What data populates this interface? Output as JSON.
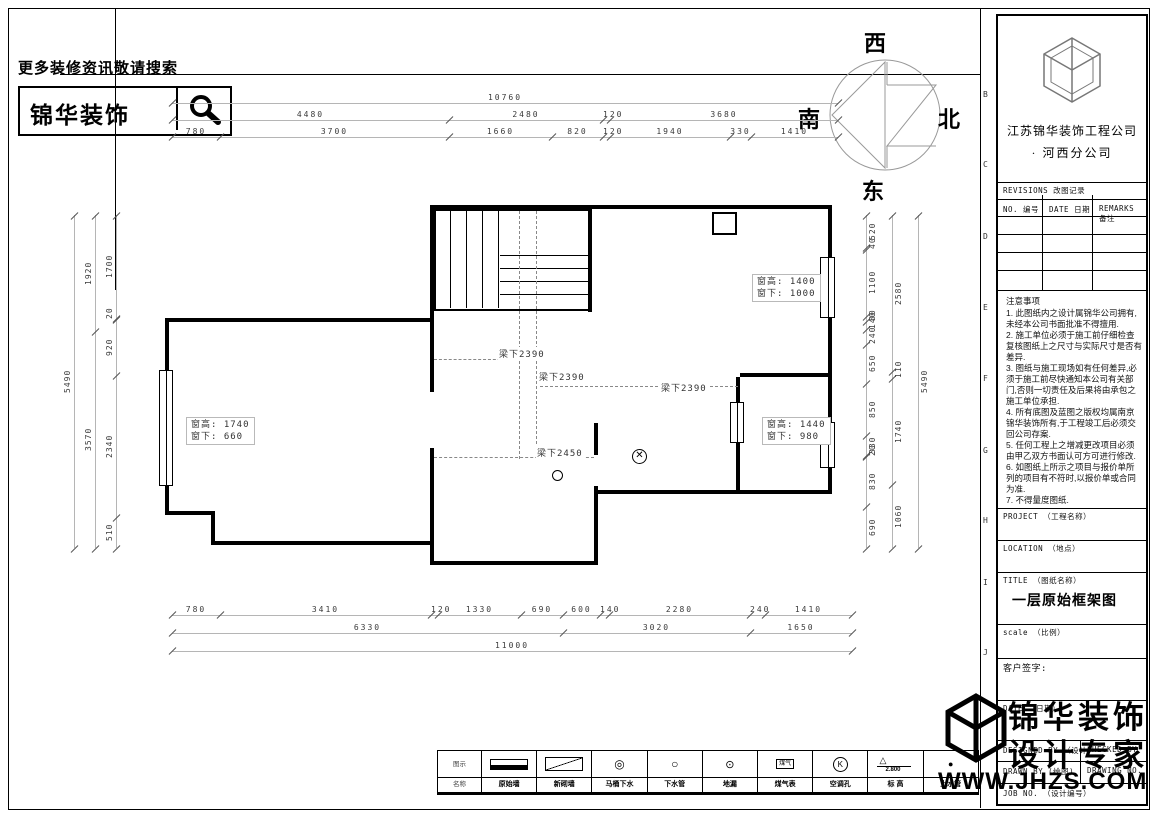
{
  "header": {
    "search_hint": "更多装修资讯敬请搜索",
    "brand": "锦华装饰",
    "search_icon": "magnifier-icon"
  },
  "compass": {
    "west": "西",
    "north": "北",
    "east": "东",
    "south": "南"
  },
  "plan": {
    "beam_labels": [
      {
        "text": "梁下2390",
        "x": 498,
        "y": 347
      },
      {
        "text": "梁下2390",
        "x": 538,
        "y": 370
      },
      {
        "text": "梁下2390",
        "x": 660,
        "y": 381
      },
      {
        "text": "梁下2450",
        "x": 536,
        "y": 446
      }
    ],
    "window_tags": [
      {
        "line1": "窗高: 1400",
        "line2": "窗下: 1000",
        "x": 752,
        "y": 274
      },
      {
        "line1": "窗高: 1740",
        "line2": "窗下: 660",
        "x": 186,
        "y": 417
      },
      {
        "line1": "窗高: 1440",
        "line2": "窗下: 980",
        "x": 762,
        "y": 417
      }
    ]
  },
  "dim_chains": [
    {
      "id": "top-total",
      "orient": "h",
      "x": 172,
      "y": 90,
      "len": 666,
      "side": "T",
      "values": [
        10760
      ]
    },
    {
      "id": "top-mid",
      "orient": "h",
      "x": 172,
      "y": 107,
      "len": 666,
      "side": "T",
      "values": [
        4480,
        2480,
        120,
        3680
      ]
    },
    {
      "id": "top-detail",
      "orient": "h",
      "x": 172,
      "y": 124,
      "len": 666,
      "side": "T",
      "values": [
        780,
        3700,
        1660,
        820,
        120,
        1940,
        330,
        1410
      ]
    },
    {
      "id": "bottom-detail",
      "orient": "h",
      "x": 172,
      "y": 602,
      "len": 680,
      "side": "T",
      "values": [
        780,
        3410,
        120,
        1330,
        690,
        600,
        140,
        2280,
        240,
        1410
      ]
    },
    {
      "id": "bottom-mid",
      "orient": "h",
      "x": 172,
      "y": 620,
      "len": 680,
      "side": "T",
      "values": [
        6330,
        3020,
        1650
      ]
    },
    {
      "id": "bottom-total",
      "orient": "h",
      "x": 172,
      "y": 638,
      "len": 680,
      "side": "T",
      "values": [
        11000
      ]
    },
    {
      "id": "left-total",
      "orient": "v",
      "x": 62,
      "y": 215,
      "len": 333,
      "side": "L",
      "values": [
        5490
      ]
    },
    {
      "id": "left-mid",
      "orient": "v",
      "x": 83,
      "y": 215,
      "len": 333,
      "side": "L",
      "values": [
        1920,
        3570
      ]
    },
    {
      "id": "left-detail",
      "orient": "v",
      "x": 104,
      "y": 215,
      "len": 333,
      "side": "L",
      "values": [
        1700,
        20,
        920,
        2340,
        510
      ]
    },
    {
      "id": "right-detail",
      "orient": "v",
      "x": 864,
      "y": 215,
      "len": 333,
      "side": "R",
      "values": [
        520,
        40,
        1100,
        80,
        140,
        240,
        650,
        850,
        330,
        20,
        830,
        690
      ]
    },
    {
      "id": "right-mid",
      "orient": "v",
      "x": 890,
      "y": 215,
      "len": 333,
      "side": "R",
      "values": [
        2580,
        110,
        1740,
        1060
      ]
    },
    {
      "id": "right-total",
      "orient": "v",
      "x": 916,
      "y": 215,
      "len": 333,
      "side": "R",
      "values": [
        5490
      ]
    }
  ],
  "legend": {
    "header_top": "图示",
    "header_bottom": "名称",
    "items": [
      {
        "name": "原始墙",
        "symbol": "wall-orig"
      },
      {
        "name": "新砌墙",
        "symbol": "wall-new"
      },
      {
        "name": "马桶下水",
        "symbol": "drain-double"
      },
      {
        "name": "下水管",
        "symbol": "drain-pipe"
      },
      {
        "name": "地漏",
        "symbol": "floor-drain"
      },
      {
        "name": "煤气表",
        "symbol": "gas-meter",
        "inner": "煤气"
      },
      {
        "name": "空调孔",
        "symbol": "ac-hole",
        "glyph": "K"
      },
      {
        "name": "标 高",
        "symbol": "level",
        "value": "2.800"
      },
      {
        "name": "上水管",
        "symbol": "water-pipe"
      }
    ]
  },
  "titleblock": {
    "company_line1": "江苏锦华装饰工程公司",
    "company_line2": "·    河西分公司",
    "revisions_title": "REVISIONS 改图记录",
    "rev_col1": "NO. 编号",
    "rev_col2": "DATE 日期",
    "rev_col3": "REMARKS 备注",
    "notes_title": "注意事项",
    "notes": [
      "1. 此图纸内之设计属锦华公司拥有,未经本公司书面批准不得擅用.",
      "2. 施工单位必须于施工前仔细检查复核图纸上之尺寸与实际尺寸是否有差异.",
      "3. 图纸与施工现场如有任何差异,必须于施工前尽快通知本公司有关部门,否则一切责任及后果将由承包之施工单位承担.",
      "4. 所有底图及蓝图之版权均属南京锦华装饰所有,于工程竣工后必须交回公司存案.",
      "5. 任何工程上之增减更改项目必须由甲乙双方书面认可方可进行修改.",
      "6. 如图纸上所示之项目与报价单所列的项目有不符时,以报价单或合同为准.",
      "7. 不得量度图纸."
    ],
    "project_label": "PROJECT （工程名称）",
    "location_label": "LOCATION （地点）",
    "title_label": "TITLE （图纸名称）",
    "drawing_title": "一层原始框架图",
    "scale_label": "scale  （比例）",
    "client_sign_label": "客户签字:",
    "date_label": "DATE （日期）",
    "designed_label": "DESIGNED BY （设计）",
    "checked_label": "CHECKED BY",
    "drawn_label": "DRAWN BY (绘图)",
    "drawing_no_label": "DRAWING NO.",
    "job_no_label": "JOB NO. （设计编号）",
    "grid_letters": [
      "B",
      "C",
      "D",
      "E",
      "F",
      "G",
      "H",
      "I",
      "J"
    ]
  },
  "watermark": {
    "line1": "锦华装饰",
    "line2": "设计专家",
    "url": "WWW.JHZS.COM",
    "logo": "cube-logo-icon"
  }
}
